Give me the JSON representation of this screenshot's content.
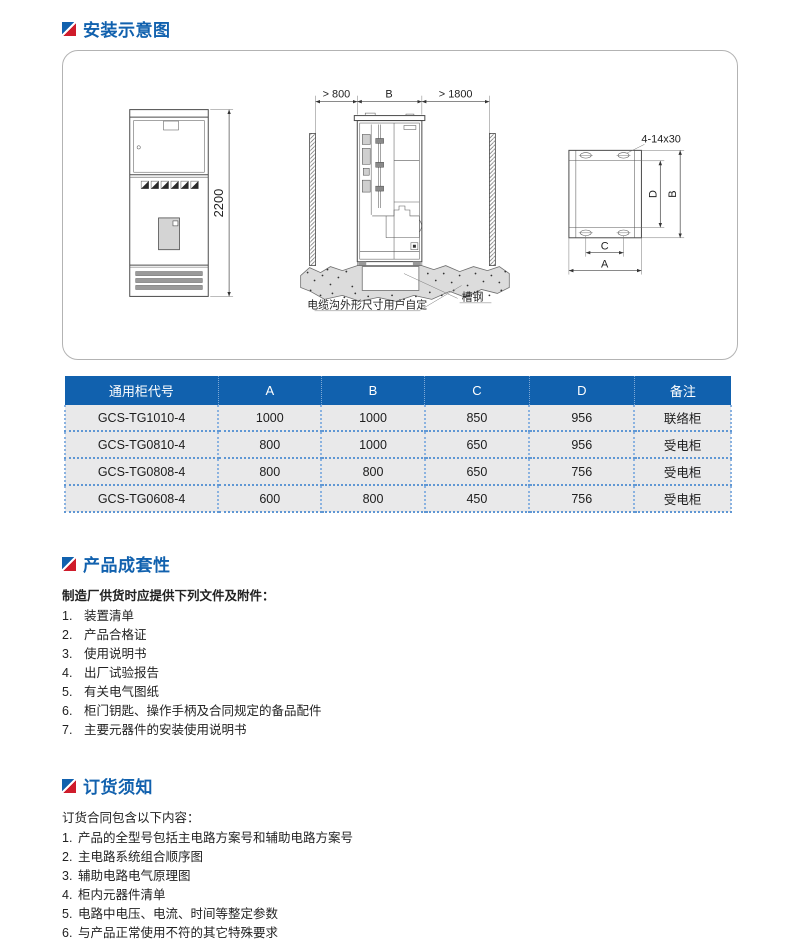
{
  "sections": {
    "install": {
      "title": "安装示意图"
    },
    "completeness": {
      "title": "产品成套性",
      "intro": "制造厂供货时应提供下列文件及附件：",
      "items": [
        {
          "num": "1.",
          "text": "装置清单"
        },
        {
          "num": "2.",
          "text": "产品合格证"
        },
        {
          "num": "3.",
          "text": "使用说明书"
        },
        {
          "num": "4.",
          "text": "出厂试验报告"
        },
        {
          "num": "5.",
          "text": "有关电气图纸"
        },
        {
          "num": "6.",
          "text": "柜门钥匙、操作手柄及合同规定的备品配件"
        },
        {
          "num": "7.",
          "text": "主要元器件的安装使用说明书"
        }
      ]
    },
    "ordering": {
      "title": "订货须知",
      "intro": "订货合同包含以下内容：",
      "items": [
        {
          "num": "1.",
          "text": "产品的全型号包括主电路方案号和辅助电路方案号"
        },
        {
          "num": "2.",
          "text": "主电路系统组合顺序图"
        },
        {
          "num": "3.",
          "text": "辅助电路电气原理图"
        },
        {
          "num": "4.",
          "text": "柜内元器件清单"
        },
        {
          "num": "5.",
          "text": "电路中电压、电流、时间等整定参数"
        },
        {
          "num": "6.",
          "text": "与产品正常使用不符的其它特殊要求"
        }
      ]
    }
  },
  "diagram": {
    "front": {
      "height": "2200"
    },
    "side": {
      "left": "> 800",
      "width": "B",
      "right": "> 1800",
      "channel": "槽钢",
      "trench": "电缆沟外形尺寸用户自定"
    },
    "plan": {
      "holes": "4-14x30",
      "a": "A",
      "b": "B",
      "c": "C",
      "d": "D"
    }
  },
  "table": {
    "headers": [
      "通用柜代号",
      "A",
      "B",
      "C",
      "D",
      "备注"
    ],
    "rows": [
      [
        "GCS-TG1010-4",
        "1000",
        "1000",
        "850",
        "956",
        "联络柜"
      ],
      [
        "GCS-TG0810-4",
        "800",
        "1000",
        "650",
        "956",
        "受电柜"
      ],
      [
        "GCS-TG0808-4",
        "800",
        "800",
        "650",
        "756",
        "受电柜"
      ],
      [
        "GCS-TG0608-4",
        "600",
        "800",
        "450",
        "756",
        "受电柜"
      ]
    ]
  },
  "colors": {
    "accent_blue": "#1161ae",
    "accent_red": "#cf1c2b",
    "row_bg": "#e9e9ea",
    "dotted_blue": "#5f97d4"
  }
}
